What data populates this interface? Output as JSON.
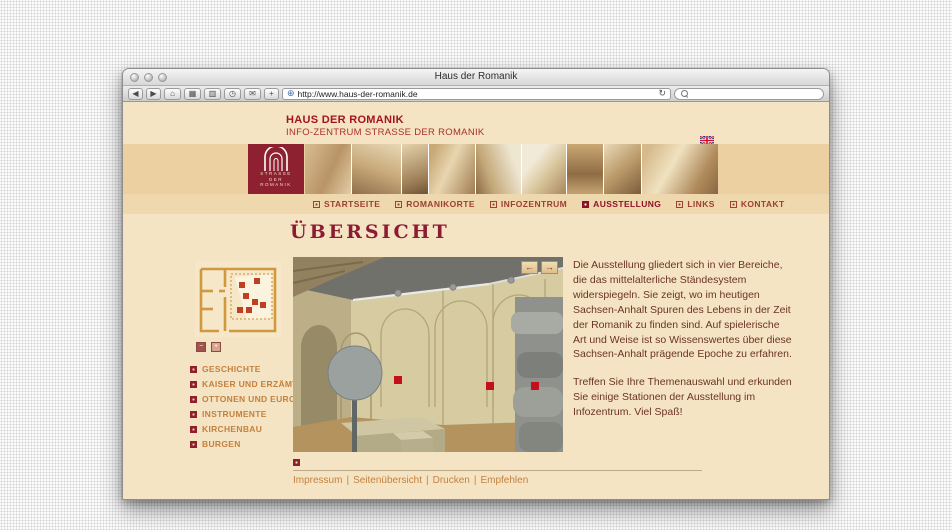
{
  "browser": {
    "window_title": "Haus der Romanik",
    "toolbar": {
      "buttons": [
        {
          "name": "back",
          "glyph": "◀"
        },
        {
          "name": "forward",
          "glyph": "▶"
        },
        {
          "name": "home",
          "glyph": "⌂"
        },
        {
          "name": "tab-overview",
          "glyph": "▦"
        },
        {
          "name": "bookmarks",
          "glyph": "▥"
        },
        {
          "name": "history",
          "glyph": "◷"
        },
        {
          "name": "mail",
          "glyph": "✉"
        },
        {
          "name": "add",
          "glyph": "+"
        }
      ],
      "url": "http://www.haus-der-romanik.de",
      "favicon_glyph": "⊕",
      "reload_glyph": "↻",
      "search_value": ""
    }
  },
  "site": {
    "brand_title": "HAUS DER ROMANIK",
    "brand_subtitle": "INFO-ZENTRUM STRASSE DER ROMANIK",
    "logo_lines": {
      "l1": "STRASSE",
      "l2": "DER",
      "l3": "ROMANIK"
    }
  },
  "nav": {
    "items": [
      {
        "label": "STARTSEITE",
        "active": false
      },
      {
        "label": "ROMANIKORTE",
        "active": false
      },
      {
        "label": "INFOZENTRUM",
        "active": false
      },
      {
        "label": "AUSSTELLUNG",
        "active": true
      },
      {
        "label": "LINKS",
        "active": false
      },
      {
        "label": "KONTAKT",
        "active": false
      }
    ]
  },
  "page": {
    "heading": "ÜBERSICHT",
    "intro_paragraph_1": "Die Ausstellung gliedert sich in vier Bereiche, die das mittelalterliche Ständesystem widerspiegeln. Sie zeigt, wo im heutigen Sachsen-Anhalt Spuren des Lebens in der Zeit der Romanik zu finden sind. Auf spielerische Art und Weise ist so Wissenswertes über diese Sachsen-Anhalt prägende Epoche zu erfahren.",
    "intro_paragraph_2": "Treffen Sie Ihre Themenauswahl und erkunden Sie einige Stationen der Ausstellung im Infozentrum. Viel Spaß!"
  },
  "sidebar": {
    "zoom_out_glyph": "−",
    "zoom_in_glyph": "+",
    "menu": [
      {
        "label": "GESCHICHTE"
      },
      {
        "label": "KAISER UND ERZÄMTER"
      },
      {
        "label": "OTTONEN UND EUROPA"
      },
      {
        "label": "INSTRUMENTE"
      },
      {
        "label": "KIRCHENBAU"
      },
      {
        "label": "BURGEN"
      }
    ]
  },
  "scene": {
    "prev_glyph": "←",
    "next_glyph": "→"
  },
  "footer": {
    "separator": "|",
    "links": [
      {
        "label": "Impressum"
      },
      {
        "label": "Seitenübersicht"
      },
      {
        "label": "Drucken"
      },
      {
        "label": "Empfehlen"
      }
    ]
  },
  "colors": {
    "brand_red": "#a5131d",
    "logo_maroon": "#8e2130",
    "cream_bg": "#f4e4c3",
    "tan_band": "#ecd0a2",
    "link_orange": "#c5803e",
    "marker_red": "#c3101c"
  }
}
